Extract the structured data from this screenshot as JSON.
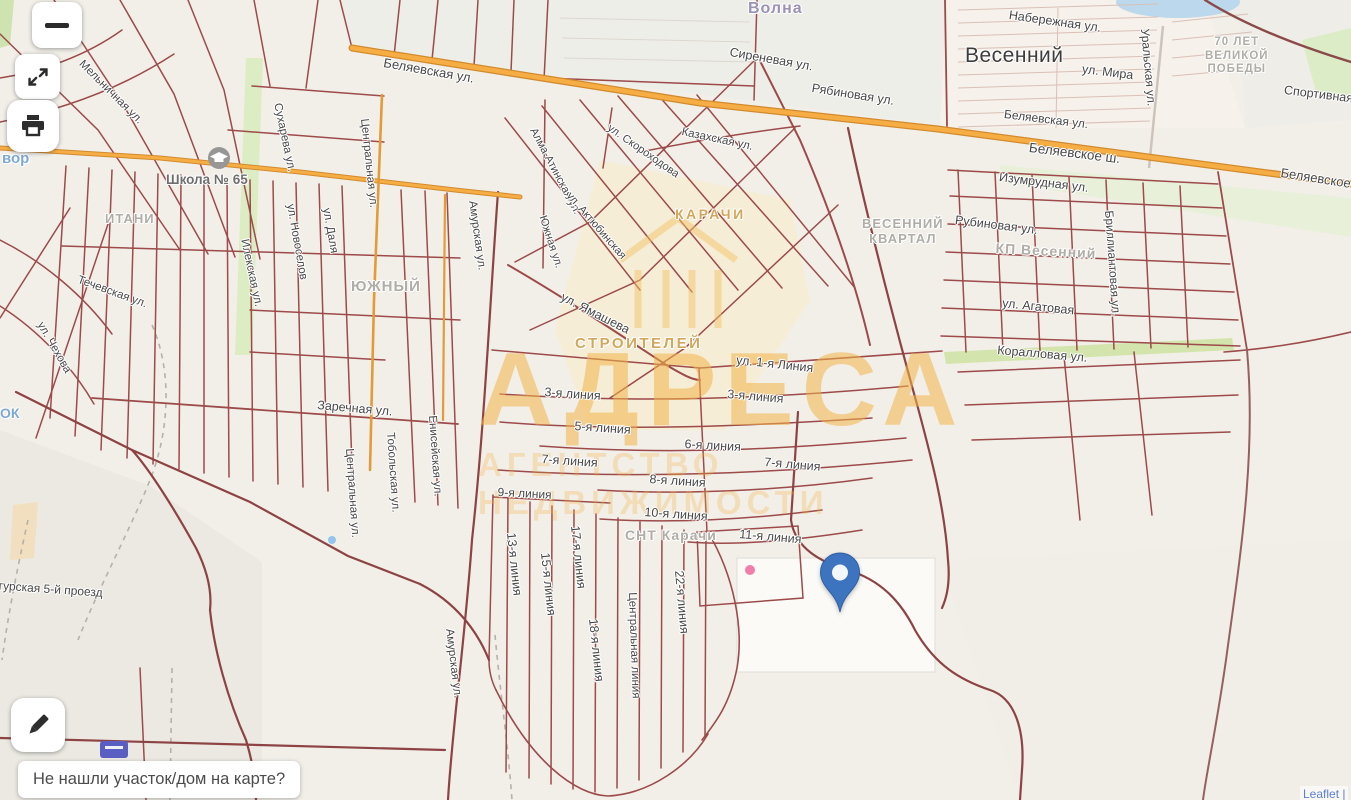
{
  "app": {
    "type": "map-viewer"
  },
  "controls": {
    "zoom_out_glyph": "−",
    "expand_icon": "expand-diagonal-arrows",
    "print_icon": "printer",
    "edit_icon": "pencil"
  },
  "prompt": "Не нашли участок/дом на карте?",
  "attribution": "Leaflet |",
  "watermark": {
    "line1": "АДРЕСА",
    "line2": "АГЕНТСТВО НЕДВИЖИМОСТИ"
  },
  "pin": {
    "shape": "map-marker",
    "color": "#3d74c0"
  },
  "colors": {
    "highway_orange": "#f2a944",
    "parcel_line": "#9c4a4a",
    "green_area": "#dcecc3",
    "water": "#bcd8ec",
    "district_text": "#cb983e",
    "pin_blue": "#3d74c0"
  },
  "labels": [
    {
      "id": "lbl-volna",
      "t": "Волна",
      "x": 748,
      "y": 0,
      "r": 0,
      "s": 16,
      "k": "volna"
    },
    {
      "id": "lbl-belyaevskaya-w",
      "t": "Беляевская ул.",
      "x": 385,
      "y": 55,
      "r": 10,
      "s": 13
    },
    {
      "id": "lbl-sirenevaya",
      "t": "Сиреневая ул.",
      "x": 731,
      "y": 45,
      "r": 10,
      "s": 12.5
    },
    {
      "id": "lbl-ryabinovaya",
      "t": "Рябиновая ул.",
      "x": 813,
      "y": 81,
      "r": 9,
      "s": 12.5
    },
    {
      "id": "lbl-vesenniy-town",
      "t": "Весенний",
      "x": 965,
      "y": 44,
      "r": 0,
      "s": 21,
      "k": "town"
    },
    {
      "id": "lbl-naberezhnaya",
      "t": "Набережная ул.",
      "x": 1010,
      "y": 8,
      "r": 8,
      "s": 12.5
    },
    {
      "id": "lbl-mira",
      "t": "ул. Мира",
      "x": 1083,
      "y": 62,
      "r": 7,
      "s": 12.5
    },
    {
      "id": "lbl-uralskaya",
      "t": "Уральская ул.",
      "x": 1152,
      "y": 28,
      "r": 85,
      "s": 12
    },
    {
      "id": "lbl-70let",
      "t": "70 ЛЕТ\nВЕЛИКОЙ\nПОБЕДЫ",
      "x": 1205,
      "y": 36,
      "r": 0,
      "s": 11.5,
      "k": "area"
    },
    {
      "id": "lbl-sportivnaya",
      "t": "Спортивная",
      "x": 1285,
      "y": 83,
      "r": 7,
      "s": 12.5
    },
    {
      "id": "lbl-belyaevskaya-c",
      "t": "Беляевская ул.",
      "x": 1005,
      "y": 107,
      "r": 7,
      "s": 12
    },
    {
      "id": "lbl-belyaevskoe-sh",
      "t": "Беляевское ш.",
      "x": 1030,
      "y": 140,
      "r": 7,
      "s": 13.5
    },
    {
      "id": "lbl-belyaevskoe-e",
      "t": "Беляевское ш.",
      "x": 1282,
      "y": 165,
      "r": 9,
      "s": 13
    },
    {
      "id": "lbl-izumrudnaya",
      "t": "Изумрудная ул.",
      "x": 1000,
      "y": 170,
      "r": 7,
      "s": 12.5
    },
    {
      "id": "lbl-rubinovaya",
      "t": "Рубиновая ул.",
      "x": 956,
      "y": 213,
      "r": 7,
      "s": 12.5
    },
    {
      "id": "lbl-kp-vesenniy",
      "t": "КП Весенний",
      "x": 996,
      "y": 240,
      "r": 3,
      "s": 14,
      "k": "area"
    },
    {
      "id": "lbl-agatovaya",
      "t": "ул. Агатовая",
      "x": 1003,
      "y": 296,
      "r": 6,
      "s": 12.5
    },
    {
      "id": "lbl-korallovaya",
      "t": "Коралловая ул.",
      "x": 998,
      "y": 343,
      "r": 5,
      "s": 12.5
    },
    {
      "id": "lbl-brilliantovaya",
      "t": "Бриллиантовая ул.",
      "x": 1116,
      "y": 210,
      "r": 86,
      "s": 12
    },
    {
      "id": "lbl-vesenniy-kvartal",
      "t": "ВЕСЕННИЙ\nКВАРТАЛ",
      "x": 862,
      "y": 216,
      "r": 0,
      "s": 13,
      "k": "area"
    },
    {
      "id": "lbl-shkola",
      "t": "Школа № 65",
      "x": 166,
      "y": 172,
      "r": 0,
      "s": 13.5,
      "k": "poi"
    },
    {
      "id": "lbl-karachi-district",
      "t": "КАРАЧИ",
      "x": 675,
      "y": 206,
      "r": 0,
      "s": 14,
      "k": "district"
    },
    {
      "id": "lbl-stroiteley",
      "t": "СТРОИТЕЛЕЙ",
      "x": 575,
      "y": 335,
      "r": 0,
      "s": 15,
      "k": "district"
    },
    {
      "id": "lbl-yamasheva",
      "t": "ул. Ямашева",
      "x": 565,
      "y": 290,
      "r": 27,
      "s": 12.5
    },
    {
      "id": "lbl-liniya-1",
      "t": "ул. 1-я Линия",
      "x": 737,
      "y": 353,
      "r": 6,
      "s": 12.5
    },
    {
      "id": "lbl-liniya-3w",
      "t": "3-я линия",
      "x": 545,
      "y": 385,
      "r": 4,
      "s": 12.5
    },
    {
      "id": "lbl-liniya-3e",
      "t": "3-я линия",
      "x": 728,
      "y": 387,
      "r": 5,
      "s": 12.5
    },
    {
      "id": "lbl-liniya-5",
      "t": "5-я линия",
      "x": 575,
      "y": 419,
      "r": 4,
      "s": 12.5
    },
    {
      "id": "lbl-liniya-6",
      "t": "6-я линия",
      "x": 685,
      "y": 437,
      "r": 3,
      "s": 12.5
    },
    {
      "id": "lbl-liniya-7w",
      "t": "7-я линия",
      "x": 542,
      "y": 452,
      "r": 4,
      "s": 12.5
    },
    {
      "id": "lbl-liniya-7e",
      "t": "7-я линия",
      "x": 765,
      "y": 455,
      "r": 5,
      "s": 12.5
    },
    {
      "id": "lbl-liniya-8",
      "t": "8-я линия",
      "x": 650,
      "y": 472,
      "r": 4,
      "s": 12.5
    },
    {
      "id": "lbl-liniya-9",
      "t": "9-я линия",
      "x": 498,
      "y": 485,
      "r": 3,
      "s": 12
    },
    {
      "id": "lbl-liniya-10",
      "t": "10-я линия",
      "x": 645,
      "y": 505,
      "r": 4,
      "s": 12.5
    },
    {
      "id": "lbl-liniya-11",
      "t": "11-я линия",
      "x": 740,
      "y": 527,
      "r": 5,
      "s": 12.5
    },
    {
      "id": "lbl-snt-karachi",
      "t": "СНТ Карачи",
      "x": 625,
      "y": 527,
      "r": 0,
      "s": 14,
      "k": "area"
    },
    {
      "id": "lbl-liniya-13",
      "t": "13-я линия",
      "x": 518,
      "y": 532,
      "r": 84,
      "s": 12.5
    },
    {
      "id": "lbl-liniya-15",
      "t": "15-я линия",
      "x": 552,
      "y": 552,
      "r": 84,
      "s": 12.5
    },
    {
      "id": "lbl-liniya-17",
      "t": "17-я линия",
      "x": 582,
      "y": 525,
      "r": 84,
      "s": 12.5
    },
    {
      "id": "lbl-liniya-18",
      "t": "18-я линия",
      "x": 600,
      "y": 618,
      "r": 84,
      "s": 12.5
    },
    {
      "id": "lbl-liniya-22",
      "t": "22-я линия",
      "x": 686,
      "y": 570,
      "r": 85,
      "s": 12.5
    },
    {
      "id": "lbl-centralnaya-liniya",
      "t": "Центральная линия",
      "x": 638,
      "y": 592,
      "r": 88,
      "s": 11.5
    },
    {
      "id": "lbl-zarechnaya",
      "t": "Заречная ул.",
      "x": 318,
      "y": 398,
      "r": 5,
      "s": 12.5
    },
    {
      "id": "lbl-centralnaya-s",
      "t": "Центральная ул.",
      "x": 355,
      "y": 448,
      "r": 86,
      "s": 11.5
    },
    {
      "id": "lbl-tobolskaya",
      "t": "Тобольская ул.",
      "x": 396,
      "y": 432,
      "r": 86,
      "s": 11.5
    },
    {
      "id": "lbl-eniseyskaya",
      "t": "Енисейская ул.",
      "x": 438,
      "y": 415,
      "r": 86,
      "s": 11.5
    },
    {
      "id": "lbl-amurskaya-s",
      "t": "Амурская ул.",
      "x": 455,
      "y": 628,
      "r": 83,
      "s": 11.5
    },
    {
      "id": "lbl-amurskaya-n",
      "t": "Амурская ул.",
      "x": 478,
      "y": 200,
      "r": 82,
      "s": 11.5
    },
    {
      "id": "lbl-ilekskaya",
      "t": "Илекская ул.",
      "x": 250,
      "y": 238,
      "r": 78,
      "s": 11.5
    },
    {
      "id": "lbl-novoselov",
      "t": "ул. Новоселов",
      "x": 296,
      "y": 203,
      "r": 80,
      "s": 11.5
    },
    {
      "id": "lbl-suhareva",
      "t": "Сухарева ул.",
      "x": 283,
      "y": 102,
      "r": 78,
      "s": 11.5
    },
    {
      "id": "lbl-dalya",
      "t": "ул. Даля",
      "x": 332,
      "y": 207,
      "r": 80,
      "s": 11.5
    },
    {
      "id": "lbl-centralnaya-n",
      "t": "Центральная ул.",
      "x": 370,
      "y": 118,
      "r": 84,
      "s": 11.5
    },
    {
      "id": "lbl-yuzhny",
      "t": "ЮЖНЫЙ",
      "x": 351,
      "y": 278,
      "r": 0,
      "s": 15,
      "k": "area"
    },
    {
      "id": "lbl-itani",
      "t": "ИТАНИ",
      "x": 105,
      "y": 211,
      "r": 0,
      "s": 13,
      "k": "area"
    },
    {
      "id": "lbl-chehova",
      "t": "ул. Чехова",
      "x": 45,
      "y": 320,
      "r": 60,
      "s": 11.5
    },
    {
      "id": "lbl-techevskaya",
      "t": "Течевская ул.",
      "x": 80,
      "y": 274,
      "r": 20,
      "s": 11.5
    },
    {
      "id": "lbl-melnichnaya",
      "t": "Мельничная ул.",
      "x": 85,
      "y": 58,
      "r": 45,
      "s": 11.5
    },
    {
      "id": "lbl-sungurskaya",
      "t": "Сунгурская 5-й проезд",
      "x": -22,
      "y": 577,
      "r": 4,
      "s": 12
    },
    {
      "id": "lbl-vor",
      "t": "вор",
      "x": 2,
      "y": 150,
      "r": 0,
      "s": 15,
      "k": "water"
    },
    {
      "id": "lbl-ok",
      "t": "ОК",
      "x": 0,
      "y": 405,
      "r": 0,
      "s": 14,
      "k": "water"
    },
    {
      "id": "lbl-kazahskaya",
      "t": "Казахская ул.",
      "x": 683,
      "y": 126,
      "r": 12,
      "s": 11.5
    },
    {
      "id": "lbl-skorohodova",
      "t": "ул. Скороходова",
      "x": 612,
      "y": 122,
      "r": 35,
      "s": 11
    },
    {
      "id": "lbl-almaatinskaya",
      "t": "Алма-Атинская ул.",
      "x": 538,
      "y": 126,
      "r": 62,
      "s": 11
    },
    {
      "id": "lbl-aktyubinskaya",
      "t": "ул. Актюбинская",
      "x": 573,
      "y": 190,
      "r": 49,
      "s": 11
    },
    {
      "id": "lbl-yuzhnaya",
      "t": "Южная ул.",
      "x": 548,
      "y": 214,
      "r": 72,
      "s": 11
    }
  ]
}
